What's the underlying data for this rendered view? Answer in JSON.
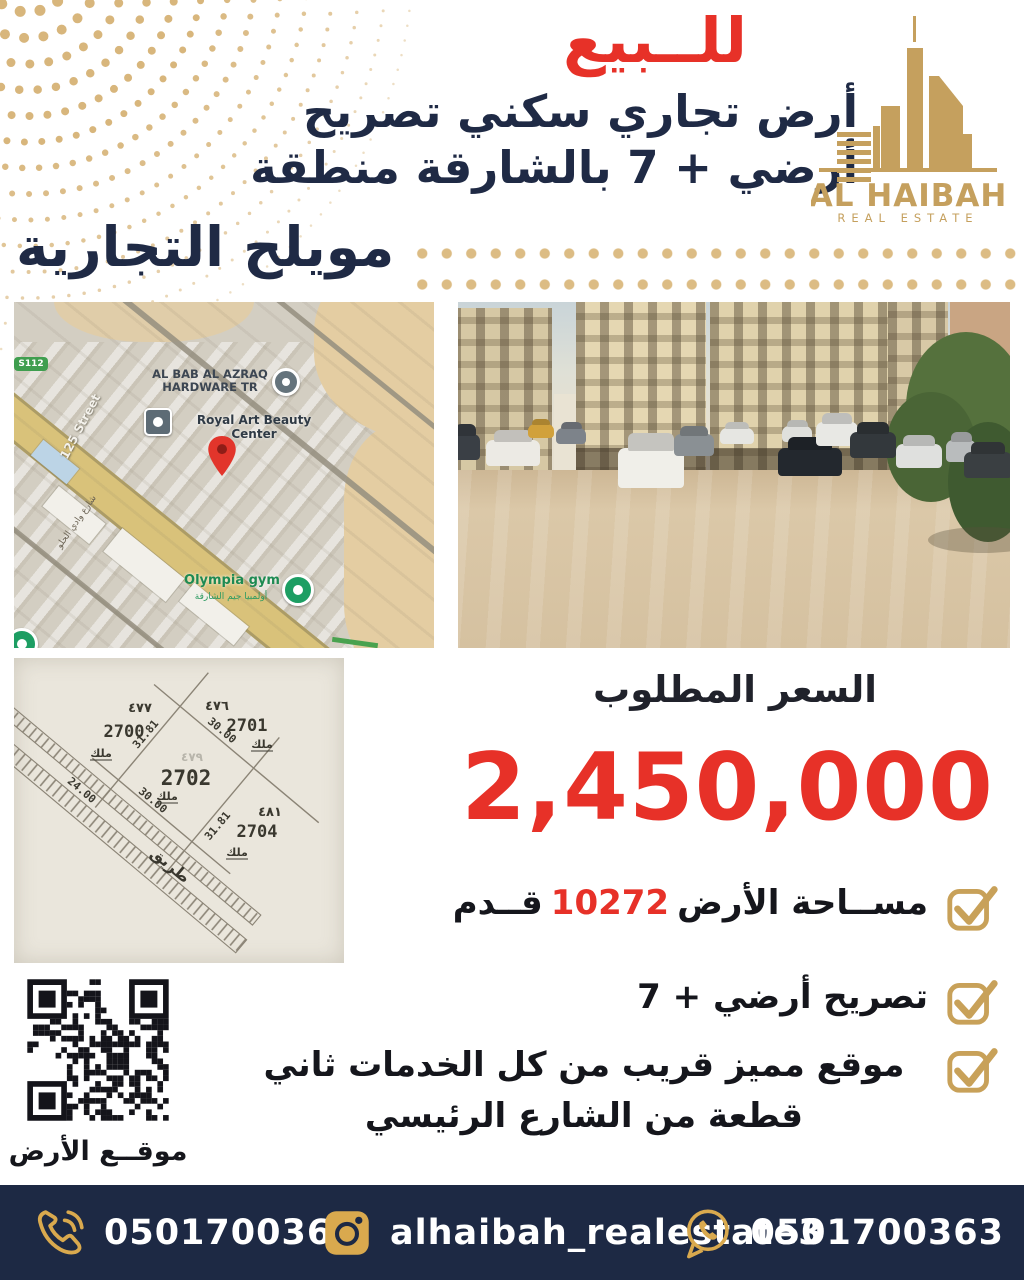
{
  "colors": {
    "navy": "#1f2a45",
    "red": "#e73128",
    "gold": "#c5a05e",
    "goldlt": "#dcbc84",
    "footerbg": "#1d2944"
  },
  "header": {
    "sale_label": "للــبيع",
    "line1": "أرض تجاري سكني تصريح",
    "line2": "أرضي + 7 بالشارقة منطقة",
    "area_title": "مويلح التجارية"
  },
  "logo": {
    "name": "AL HAIBAH",
    "subtitle": "REAL ESTATE"
  },
  "map": {
    "labels": {
      "route_badge": "S112",
      "street": "125 Street",
      "street_ar": "شارع وادي الحلو",
      "hardware_line1": "AL BAB AL AZRAQ",
      "hardware_line2": "HARDWARE TR",
      "beauty": "Royal Art Beauty Center",
      "gym": "Olympia gym",
      "gym_ar": "أولمبيا جيم الشارقة"
    }
  },
  "sketch": {
    "plot_number": "2702",
    "center_faint": "٤٧٩",
    "owner_label": "ملك",
    "n1_num": "٤٧٧",
    "n1_plot": "2700",
    "n2_num": "٤٧٦",
    "n2_plot": "2701",
    "n3_num": "٤٨١",
    "n3_plot": "2704",
    "dim_top_left": "31.81",
    "dim_top_right": "30.00",
    "dim_bottom_left": "30.00",
    "dim_bottom_right": "31.81",
    "road_width": "24.00",
    "road_label": "طريق"
  },
  "price": {
    "label": "السعر المطلوب",
    "value": "2,450,000"
  },
  "features": {
    "f1_pre": "مســاحة الأرض",
    "f1_value": "10272",
    "f1_post": "قــدم",
    "f2": "تصريح أرضي + 7",
    "f3": "موقع مميز قريب من كل الخدمات ثاني قطعة من الشارع الرئيسي"
  },
  "qr": {
    "caption": "موقــع الأرض"
  },
  "footer": {
    "phone1": "0501700363",
    "instagram": "alhaibah_realestate3",
    "phone2": "0501700363"
  }
}
